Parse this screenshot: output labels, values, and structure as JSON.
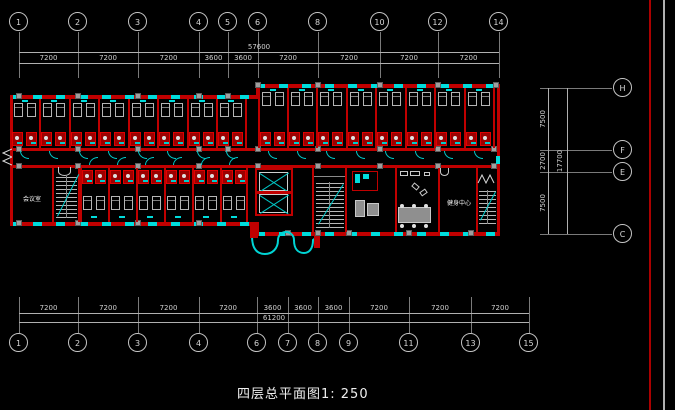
{
  "title": "四层总平面图1: 250",
  "axes": {
    "top": {
      "bubbles": [
        "1",
        "2",
        "3",
        "4",
        "5",
        "6",
        "8",
        "10",
        "12",
        "14"
      ],
      "segments": [
        "7200",
        "7200",
        "7200",
        "3600",
        "3600",
        "7200",
        "7200",
        "7200",
        "7200"
      ],
      "total": "57600"
    },
    "bottom": {
      "bubbles": [
        "1",
        "2",
        "3",
        "4",
        "6",
        "7",
        "8",
        "9",
        "11",
        "13",
        "15"
      ],
      "segments": [
        "7200",
        "7200",
        "7200",
        "7200",
        "3600",
        "3600",
        "3600",
        "7200",
        "7200",
        "7200"
      ],
      "total": "61200"
    },
    "right": {
      "bubbles": [
        "H",
        "F",
        "E",
        "C"
      ],
      "segments": [
        "7500",
        "2700",
        "7500"
      ],
      "total": "17700"
    }
  },
  "room_labels": {
    "meeting_room": "会议室",
    "center": "健身中心"
  },
  "colors": {
    "background": "#000000",
    "wall_red": "#c00000",
    "window_cyan": "#00dcdc",
    "line_gray": "#b5b5b5",
    "frame_red": "#aa0000",
    "frame_gray": "#b0b0b0"
  }
}
